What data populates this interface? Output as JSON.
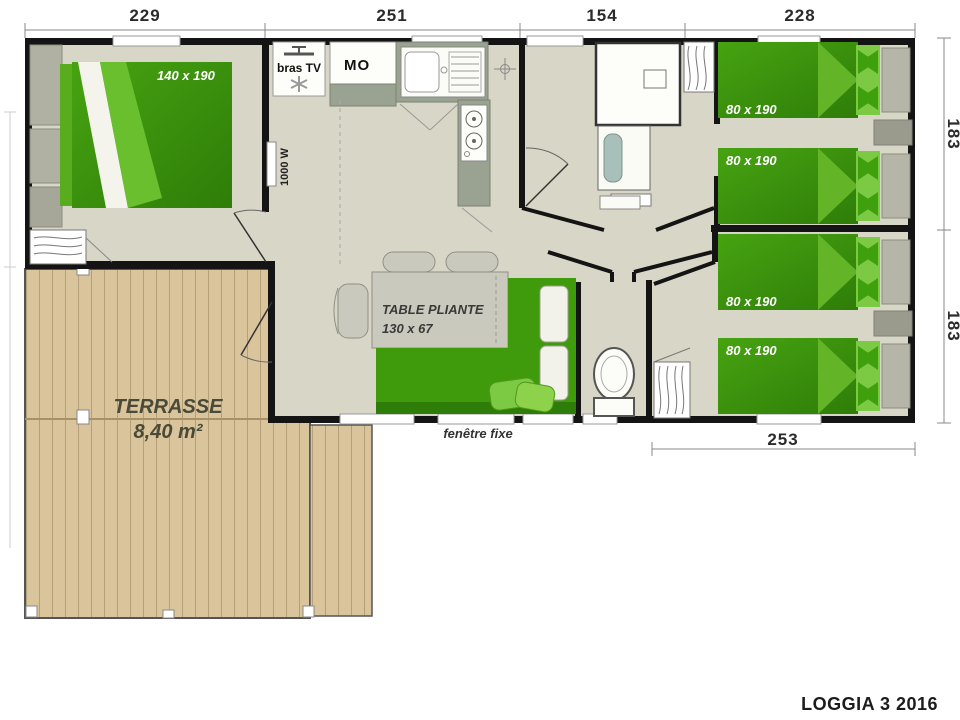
{
  "plan": {
    "title": "LOGGIA 3 2016",
    "dim_top": [
      "229",
      "251",
      "154",
      "228"
    ],
    "dim_right": [
      "183",
      "183"
    ],
    "dim_bottom": "253",
    "rooms": {
      "master_bed_label": "140 x 190",
      "twin_bed_labels": [
        "80 x 190",
        "80 x 190",
        "80 x 190",
        "80 x 190"
      ],
      "table_label": "TABLE PLIANTE",
      "table_size": "130 x 67",
      "terrace_name": "TERRASSE",
      "terrace_area": "8,40 m²",
      "tv_label": "bras TV",
      "microwave_label": "MO",
      "heater_label": "1000 W",
      "window_label": "fenêtre fixe"
    },
    "colors": {
      "wall": "#141414",
      "floor": "#d8d6c6",
      "wood": "#d9c49c",
      "bed_green_dark": "#2e7d08",
      "bed_green": "#47a311",
      "pillow_green": "#7cc944"
    }
  }
}
